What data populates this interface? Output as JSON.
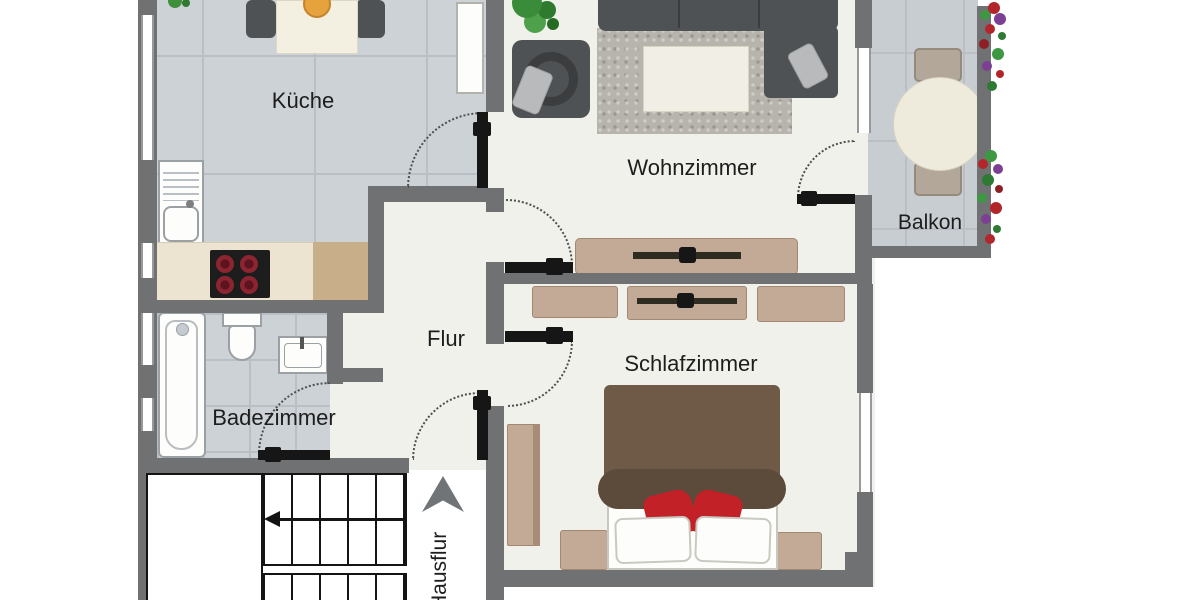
{
  "floorplan": {
    "rooms": [
      {
        "id": "kueche",
        "label": "Küche"
      },
      {
        "id": "wohnzimmer",
        "label": "Wohnzimmer"
      },
      {
        "id": "balkon",
        "label": "Balkon"
      },
      {
        "id": "flur",
        "label": "Flur"
      },
      {
        "id": "schlafzimmer",
        "label": "Schlafzimmer"
      },
      {
        "id": "badezimmer",
        "label": "Badezimmer"
      },
      {
        "id": "hausflur",
        "label": "Hausflur"
      }
    ],
    "colors": {
      "wall": "#6f7173",
      "door": "#161616",
      "floor": "#f0f1ea",
      "tile": "#cdd2d7",
      "grout": "#b9bfc5",
      "furniture_wood": "#c3aa96",
      "sofa_gray": "#4f5254",
      "bed_blanket": "#6e5a47",
      "accent_red": "#c22127",
      "plant_green": "#3e9842",
      "label_text": "#1d1d1d"
    },
    "furniture": [
      "dining-table",
      "kitchen-chairs",
      "fruit-bowl",
      "refrigerator",
      "kitchen-sink",
      "cooktop",
      "countertop",
      "bathtub",
      "toilet",
      "washbasin",
      "corner-sofa",
      "armchair",
      "rug",
      "coffee-table",
      "sideboard",
      "potted-plant",
      "bed",
      "pillows",
      "nightstands",
      "wardrobe",
      "dressers",
      "balcony-table",
      "balcony-chairs",
      "flower-boxes",
      "staircase",
      "direction-arrow"
    ]
  }
}
